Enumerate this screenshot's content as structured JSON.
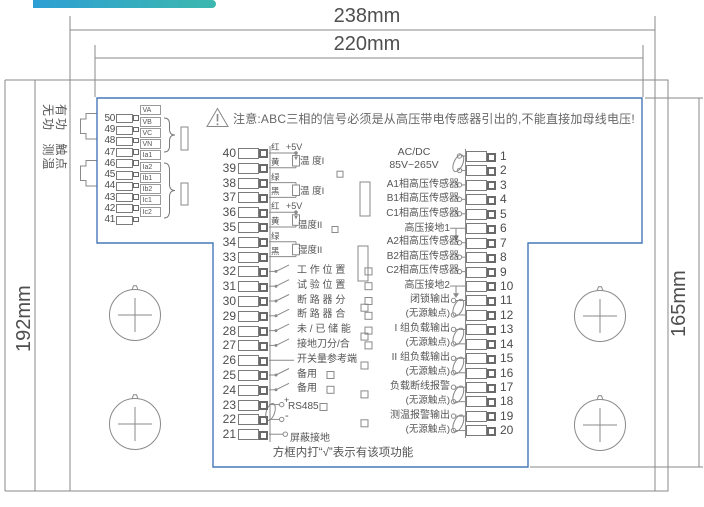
{
  "dimensions": {
    "outer_width": "238mm",
    "inner_width": "220mm",
    "left_height": "192mm",
    "right_height": "165mm"
  },
  "side_labels": {
    "left_column": "无功 测温",
    "right_column": "有功 触点"
  },
  "warning_text": "注意:ABC三相的信号必须是从高压带电传感器引出的,不能直接加母线电压!",
  "left_block": {
    "rows": [
      {
        "num": "50",
        "label": "VA"
      },
      {
        "num": "49",
        "label": "VB"
      },
      {
        "num": "48",
        "label": "VC"
      },
      {
        "num": "47",
        "label": "VN"
      },
      {
        "num": "46",
        "label": "Ia1"
      },
      {
        "num": "45",
        "label": "Ia2"
      },
      {
        "num": "44",
        "label": "Ib1"
      },
      {
        "num": "43",
        "label": "Ib2"
      },
      {
        "num": "42",
        "label": "Ic1"
      },
      {
        "num": "41",
        "label": "Ic2"
      }
    ]
  },
  "middle_block": {
    "numbers": [
      "40",
      "39",
      "38",
      "37",
      "36",
      "35",
      "34",
      "33",
      "32",
      "31",
      "30",
      "29",
      "28",
      "27",
      "26",
      "25",
      "24",
      "23",
      "22",
      "21"
    ],
    "sensor_groups": [
      {
        "wire_labels": [
          "红",
          "黄",
          "绿",
          "黑"
        ],
        "supply": "+5V",
        "channel1": "温 度I",
        "channel2": "温 度I"
      },
      {
        "wire_labels": [
          "红",
          "黄",
          "绿",
          "黑"
        ],
        "supply": "+5V",
        "channel1": "温度II",
        "channel2": "湿度II"
      }
    ],
    "input_labels": [
      "工 作 位 置",
      "试 验 位 置",
      "断 路 器 分",
      "断 路 器 合",
      "未 / 已 储 能",
      "接地刀分/合",
      "开关量参考端",
      "备用",
      "备用"
    ],
    "rs485_label": "RS485",
    "rs485_plus": "+",
    "rs485_minus": "-",
    "shield_label": "屏蔽接地"
  },
  "right_block": {
    "numbers": [
      "1",
      "2",
      "3",
      "4",
      "5",
      "6",
      "7",
      "8",
      "9",
      "10",
      "11",
      "12",
      "13",
      "14",
      "15",
      "16",
      "17",
      "18",
      "19",
      "20"
    ],
    "power_label_line1": "AC/DC",
    "power_label_line2": "85V~265V",
    "sensor_group1": [
      "A1相高压传感器",
      "B1相高压传感器",
      "C1相高压传感器"
    ],
    "ground1": "高压接地1",
    "sensor_group2": [
      "A2相高压传感器",
      "B2相高压传感器",
      "C2相高压传感器"
    ],
    "ground2": "高压接地2",
    "outputs": [
      {
        "line1": "闭锁输出",
        "line2": "(无源触点)"
      },
      {
        "line1": "I 组负载输出",
        "line2": "(无源触点)"
      },
      {
        "line1": "II 组负载输出",
        "line2": "(无源触点)"
      },
      {
        "line1": "负载断线报警",
        "line2": "(无源触点)"
      },
      {
        "line1": "测温报警输出",
        "line2": "(无源触点)"
      }
    ]
  },
  "footer_note": "方框内打“√”表示有该项功能",
  "colors": {
    "outline_blue": "#4678b8",
    "line_gray": "#8a8a8a",
    "accent_teal": "#3db8ae"
  }
}
